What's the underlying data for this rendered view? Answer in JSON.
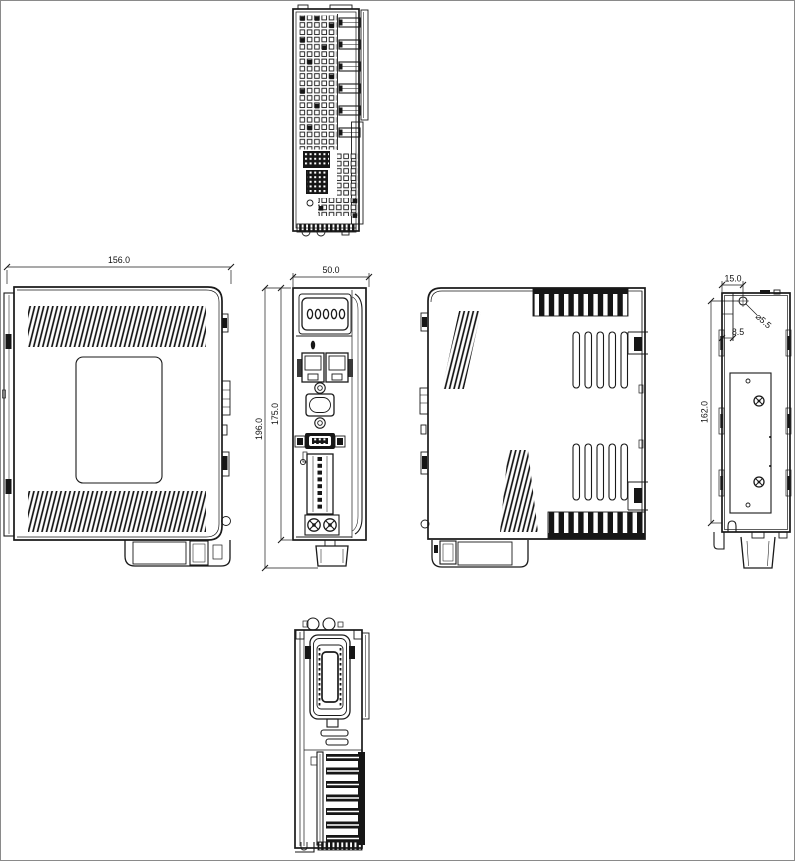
{
  "drawing": {
    "background_color": "#ffffff",
    "line_color": "#1a1a1a",
    "dimensions": {
      "side_width": "156.0",
      "front_width": "50.0",
      "overall_height": "196.0",
      "panel_height": "175.0",
      "rear_hole_offset": "15.0",
      "rear_hole_pitch": "162.0",
      "rear_step_offset": "8.5",
      "hole_diameter": "⌀5.5"
    }
  }
}
